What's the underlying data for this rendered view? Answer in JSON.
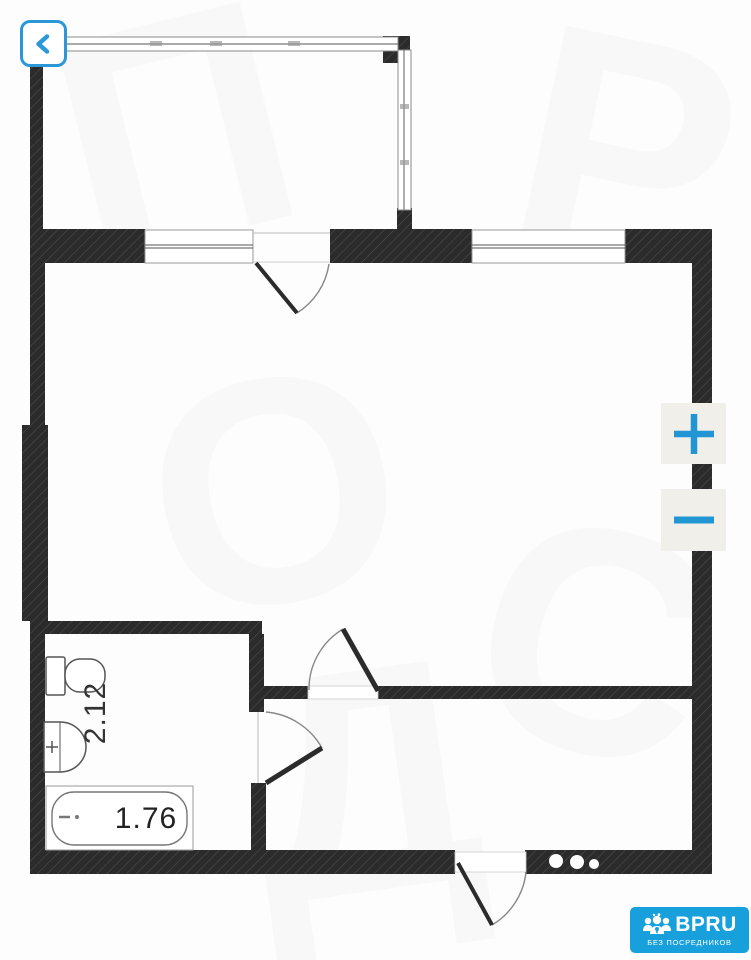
{
  "toolbar": {
    "back_icon": "chevron-left",
    "zoom_in_icon": "plus",
    "zoom_out_icon": "minus"
  },
  "floorplan": {
    "bathroom_dimension_label": "2.12",
    "bathtub_dimension_label": "1.76",
    "wall_color": "#2b2b2b",
    "fixtures": [
      "toilet",
      "sink",
      "bathtub"
    ]
  },
  "brand_badge": {
    "name": "BPRU",
    "tagline": "БЕЗ ПОСРЕДНИКОВ",
    "background_color": "#18a0dd",
    "logo_icon": "people-group"
  },
  "colors": {
    "accent_blue": "#2196d3",
    "zoom_button_background": "#f1efe9"
  }
}
